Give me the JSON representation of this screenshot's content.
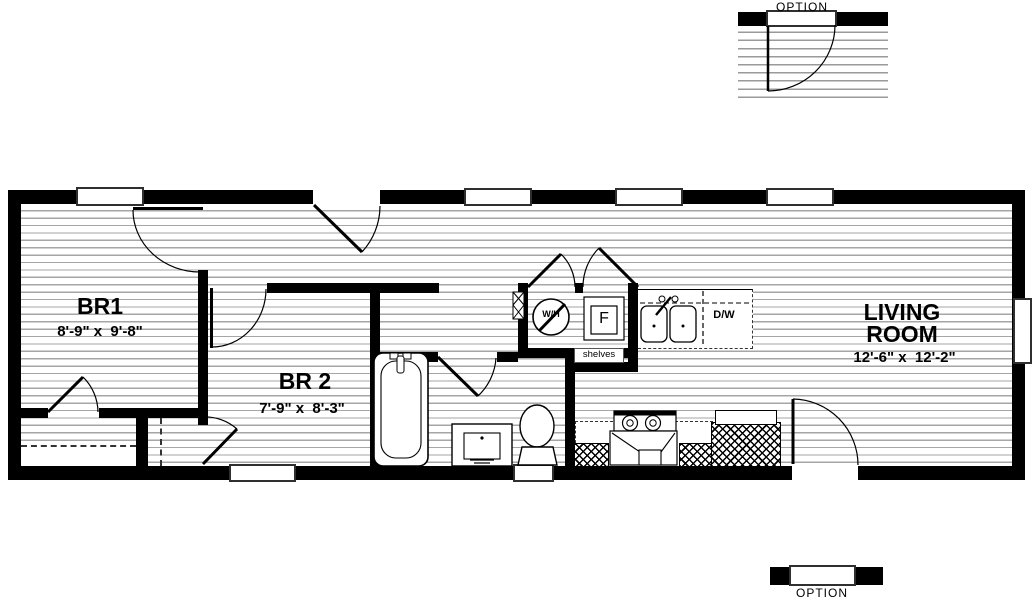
{
  "colors": {
    "wall": "#000000",
    "floor_line": "#a6a6a6",
    "background": "#ffffff",
    "text": "#000000"
  },
  "top_option": {
    "label": "OPTION"
  },
  "bottom_option": {
    "label": "OPTION"
  },
  "rooms": {
    "br1": {
      "name": "BR1",
      "dims": "8'-9\" x  9'-8\""
    },
    "br2": {
      "name": "BR 2",
      "dims": "7'-9\" x  8'-3\""
    },
    "living": {
      "line1": "LIVING",
      "line2": "ROOM",
      "dims": "12'-6\" x  12'-2\""
    }
  },
  "utility": {
    "water_heater": "W/H",
    "furnace": "F",
    "shelves": "shelves"
  },
  "kitchen": {
    "dishwasher": "D/W"
  },
  "fixture_names": [
    "bathtub",
    "toilet",
    "vanity-sink",
    "kitchen-double-sink",
    "dishwasher",
    "range",
    "refrigerator",
    "water-heater",
    "furnace",
    "closet-rod",
    "shelves"
  ]
}
